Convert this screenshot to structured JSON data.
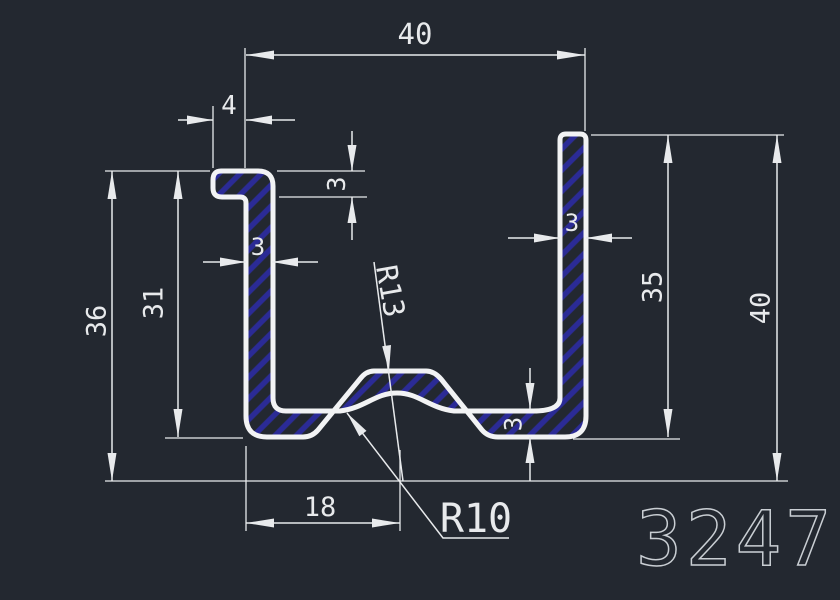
{
  "drawing": {
    "part_number": "3247",
    "dims": {
      "overall_width": "40",
      "lip_overhang": "4",
      "lip_thickness": "3",
      "left_wall_thickness": "3",
      "inner_height_left": "31",
      "overall_height_left": "36",
      "right_wall_thickness": "3",
      "inner_height_right": "35",
      "overall_height_right": "40",
      "bottom_thickness": "3",
      "bump_offset": "18",
      "top_radius": "R13",
      "bottom_radius": "R10"
    },
    "colors": {
      "background": "#232830",
      "line": "#e8eaec",
      "profile": "#f2f3f4",
      "hatch": "#2b2b96",
      "part_number": "#c9ced3"
    }
  }
}
